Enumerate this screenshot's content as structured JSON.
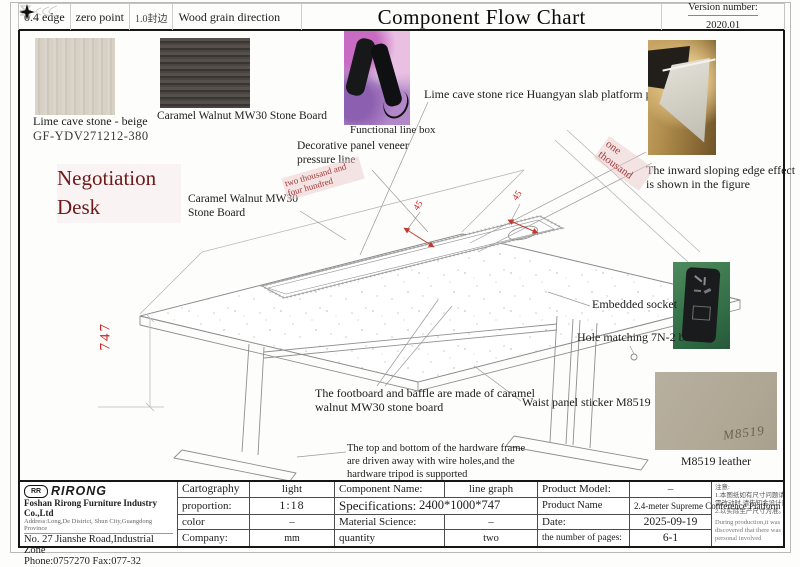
{
  "header": {
    "edge04": "0.4 edge",
    "zero_point": "zero point",
    "edge10": "1.0封边",
    "wood_grain": "Wood grain direction",
    "title": "Component Flow Chart",
    "version_label": "Version number:",
    "version_value": "2020.01"
  },
  "colors": {
    "accent_red": "#c03a30",
    "title_maroon": "#6d1a1a",
    "pink_highlight": "#f0d6d6"
  },
  "product": {
    "title": "Negotiation Desk"
  },
  "materials": {
    "lime_caption": "Lime cave stone - beige",
    "lime_code": "GF-YDV271212-380",
    "walnut_caption": "Caramel Walnut MW30 Stone Board",
    "m8519_mark": "M8519",
    "m8519_caption": "M8519 leather"
  },
  "annotations": {
    "functional_box": "Functional line box",
    "decorative_line": "Decorative panel veneer pressure line",
    "slab_panel": "Lime cave stone rice Huangyan slab platform panel",
    "caramel_board": "Caramel Walnut MW30 Stone Board",
    "inward_edge": "The inward sloping edge effect is shown in the figure",
    "embedded_socket": "Embedded socket",
    "hole_matching": "Hole matching 7N-2 buckle",
    "waist_panel": "Waist panel sticker M8519",
    "footboard": "The footboard and baffle are made of caramel walnut MW30 stone board",
    "hardware_frame": "The top and bottom of the hardware frame are driven away with wire holes,and the hardware tripod is supported"
  },
  "dimensions": {
    "height": "747",
    "length_text": "two thousand and four hundred",
    "width_text": "one thousand",
    "chamfer_left": "45",
    "chamfer_right": "45"
  },
  "company": {
    "logo": "RIRONG",
    "logo_badge": "RR",
    "name": "Foshan Rirong Furniture Industry Co.,Ltd",
    "address": "Address:Long,De District, Shun City,Guangdong Province",
    "street": "No. 27 Jianshe Road,Industrial Zone",
    "phone": "Phone:0757270 Fax:077-32"
  },
  "title_block": {
    "cartography_label": "Cartography",
    "cartography_value": "light",
    "proportion_label": "proportion:",
    "proportion_value": "1:18",
    "color_label": "color",
    "color_value": "–",
    "company_label": "Company:",
    "company_value": "mm",
    "component_label": "Component Name:",
    "component_value": "line graph",
    "spec_label": "Specifications:",
    "spec_value": "2400*1000*747",
    "material_label": "Material Science:",
    "material_value": "–",
    "quantity_label": "quantity",
    "quantity_value": "two",
    "model_label": "Product Model:",
    "model_value": "–",
    "pname_label": "Product Name",
    "pname_value": "2.4-meter Supreme Conference Platform",
    "date_label": "Date:",
    "date_value": "2025-09-19",
    "pages_label": "the number of pages:",
    "pages_value": "6-1"
  },
  "notes": {
    "lines": [
      "注意:",
      "1.本图纸如有尺寸问题请及时反馈,",
      "需改动时,请先知会设计部。",
      "2.以实际生产尺寸为准。  一般",
      "During production,it was",
      "discovered that there was some",
      "personal involved"
    ]
  }
}
